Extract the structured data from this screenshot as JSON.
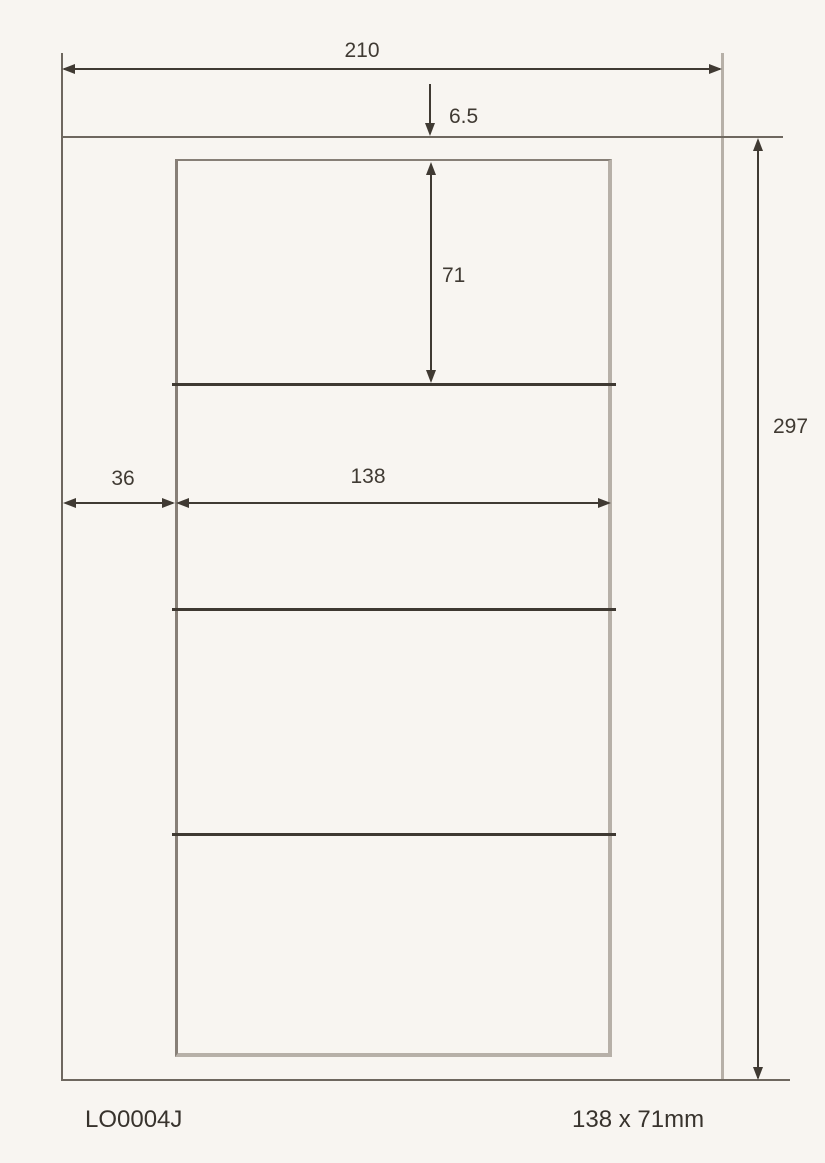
{
  "drawing": {
    "dimensions": {
      "sheet_width": "210",
      "top_margin": "6.5",
      "label_height": "71",
      "left_margin": "36",
      "label_width": "138",
      "sheet_height": "297"
    },
    "label_rows": 4
  },
  "footer": {
    "product_code": "LO0004J",
    "label_size": "138 x 71mm"
  },
  "colors": {
    "background": "#f8f5f1",
    "dimension_ink": "#403a33",
    "sheet_outline": "#6e675f",
    "sheet_outline_light": "#b7b0a8",
    "label_outline": "#877f77",
    "divider": "#3f3932",
    "footer_text": "#38332d"
  }
}
